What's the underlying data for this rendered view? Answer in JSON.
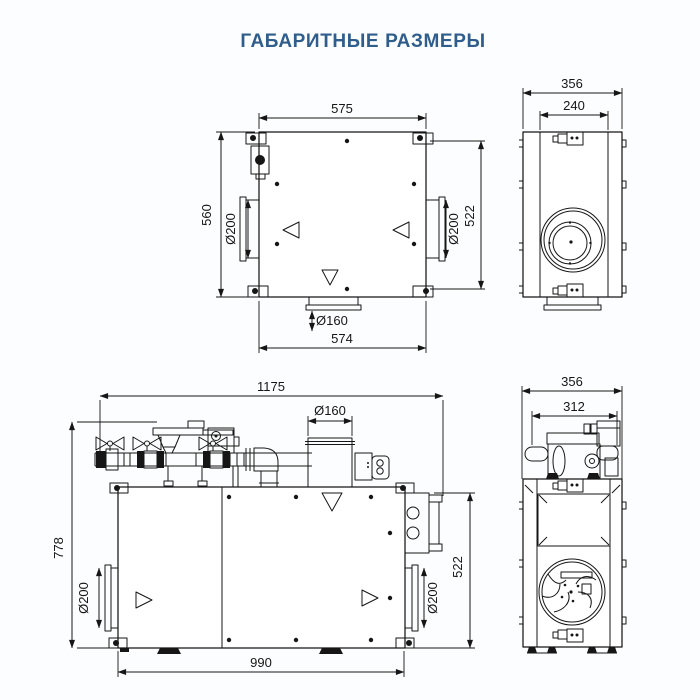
{
  "title": {
    "text": "ГАБАРИТНЫЕ РАЗМЕРЫ",
    "color": "#2f5d8c"
  },
  "drawing": {
    "line_color": "#161616",
    "background": "#fcfdfe"
  },
  "views": {
    "top": {
      "dims": {
        "width_top": "575",
        "height_left": "560",
        "height_right": "522",
        "port_left": "Ø200",
        "port_right": "Ø200",
        "port_bottom": "Ø160",
        "width_bottom": "574"
      }
    },
    "side_upper": {
      "dims": {
        "depth_outer": "356",
        "depth_inner": "240"
      }
    },
    "front": {
      "dims": {
        "width_total": "1175",
        "port_top": "Ø160",
        "height_total": "778",
        "port_left": "Ø200",
        "port_right": "Ø200",
        "height_body": "522",
        "width_body": "990"
      }
    },
    "side_lower": {
      "dims": {
        "depth_outer": "356",
        "depth_inner": "312"
      }
    }
  }
}
